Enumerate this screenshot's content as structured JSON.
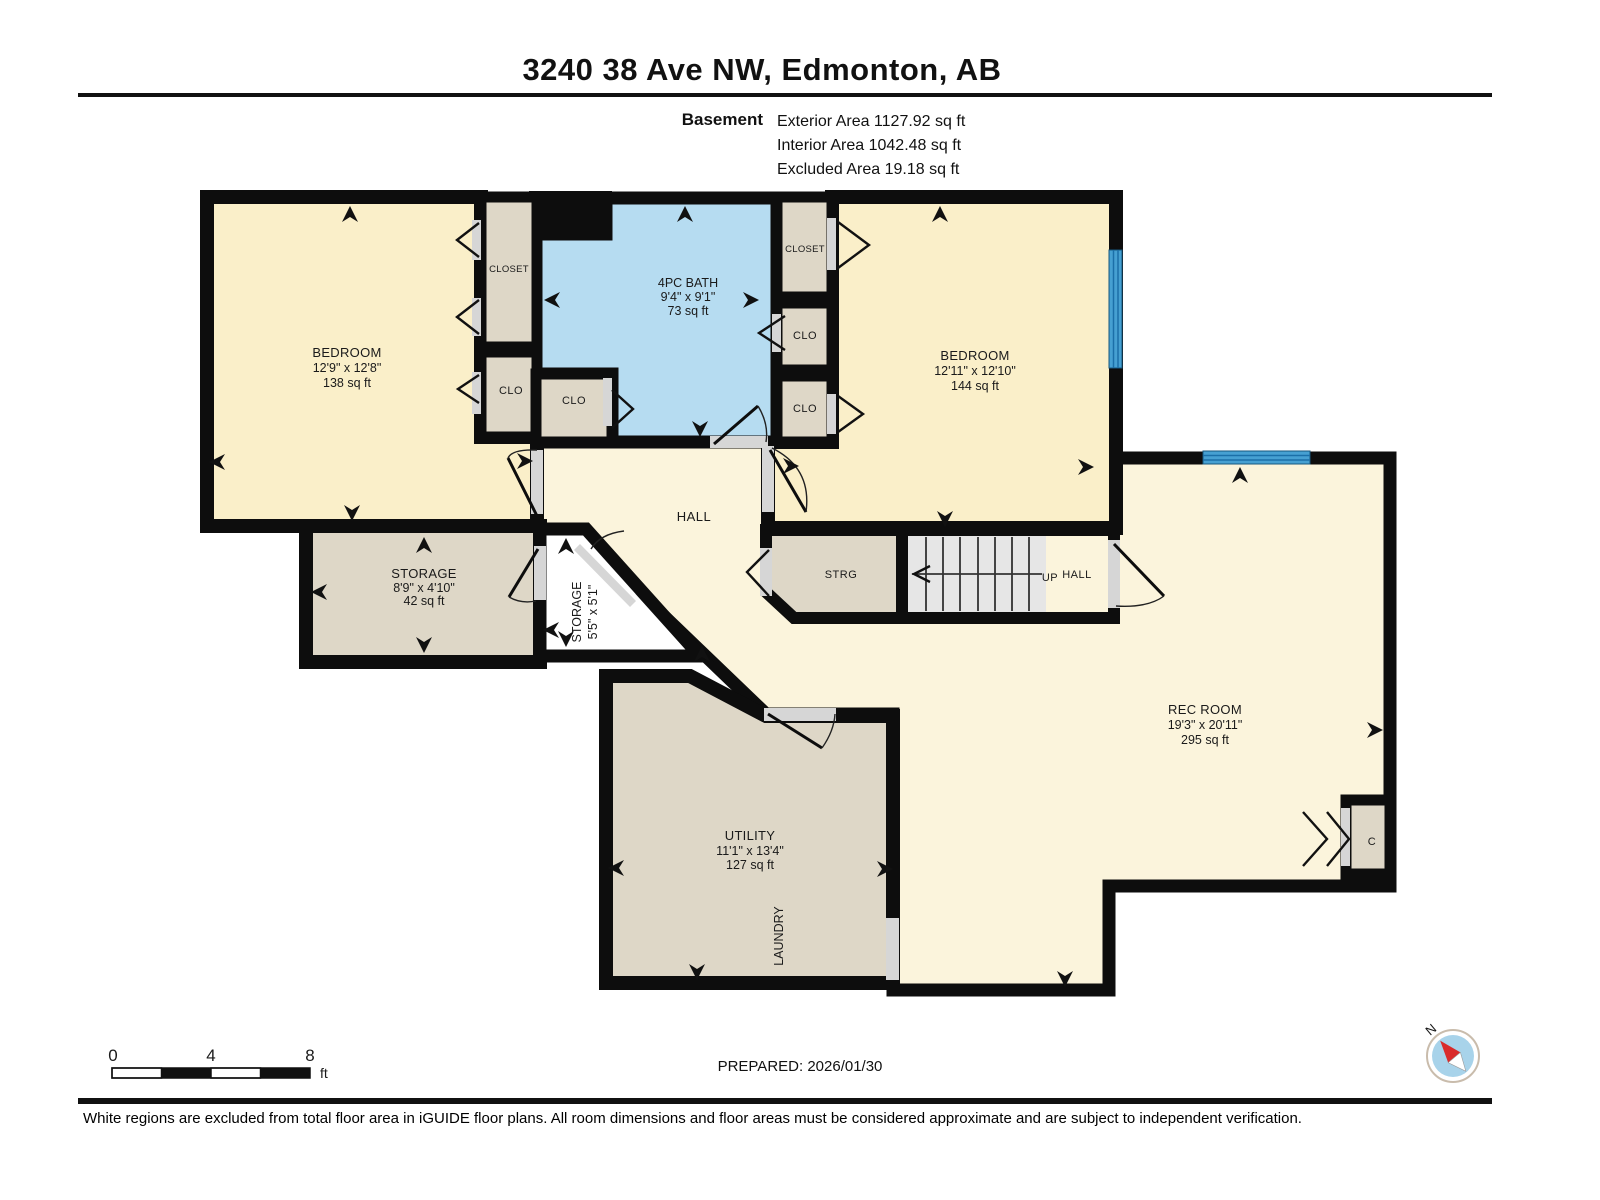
{
  "header": {
    "title": "3240 38 Ave NW, Edmonton, AB",
    "floor_label": "Basement",
    "area_lines": [
      {
        "label": "Exterior Area",
        "value": "1127.92 sq ft",
        "text": "Exterior Area 1127.92 sq ft"
      },
      {
        "label": "Interior Area",
        "value": "1042.48 sq ft",
        "text": "Interior Area 1042.48 sq ft"
      },
      {
        "label": "Excluded Area",
        "value": "19.18 sq ft",
        "text": "Excluded Area 19.18 sq ft"
      }
    ]
  },
  "rooms": {
    "bedroom_left": {
      "name": "BEDROOM",
      "dims": "12'9\" x 12'8\"",
      "area": "138 sq ft"
    },
    "bedroom_right": {
      "name": "BEDROOM",
      "dims": "12'11\" x 12'10\"",
      "area": "144 sq ft"
    },
    "bath": {
      "name": "4PC BATH",
      "dims": "9'4\" x 9'1\"",
      "area": "73 sq ft"
    },
    "rec_room": {
      "name": "REC ROOM",
      "dims": "19'3\" x 20'11\"",
      "area": "295 sq ft"
    },
    "utility": {
      "name": "UTILITY",
      "dims": "11'1\" x 13'4\"",
      "area": "127 sq ft"
    },
    "laundry": {
      "name": "LAUNDRY"
    },
    "storage": {
      "name": "STORAGE",
      "dims": "8'9\" x 4'10\"",
      "area": "42 sq ft"
    },
    "storage_small": {
      "name": "STORAGE",
      "dims": "5'5\" x 5'1\""
    },
    "hall": {
      "name": "HALL"
    },
    "strg": {
      "name": "STRG"
    },
    "stairs": {
      "up_label": "UP"
    },
    "hall_landing": {
      "name": "HALL"
    },
    "closet_left": {
      "name": "CLOSET"
    },
    "clo_left": {
      "name": "CLO"
    },
    "clo_bath": {
      "name": "CLO"
    },
    "closet_right": {
      "name": "CLOSET"
    },
    "clo_right_mid": {
      "name": "CLO"
    },
    "clo_right_bot": {
      "name": "CLO"
    },
    "closet_rec": {
      "name": "C"
    }
  },
  "footer": {
    "scale": {
      "t0": "0",
      "t4": "4",
      "t8": "8",
      "unit": "ft"
    },
    "prepared": "PREPARED: 2026/01/30",
    "compass_label": "N",
    "disclaimer": "White regions are excluded from total floor area in iGUIDE floor plans. All room dimensions and floor areas must be considered approximate and are subject to independent verification."
  },
  "colors": {
    "room_warm": "#FAEFC9",
    "room_light": "#FBF4DC",
    "closet_tan": "#DED7C7",
    "bath_blue": "#B6DCF1",
    "window_blue": "#46A0D2",
    "window_dark": "#1B6FA8",
    "wall": "#0D0D0D",
    "door_gray": "#D6D6D6",
    "stairs_gray": "#E6E6E6",
    "compass_red": "#D92B2B",
    "compass_blue": "#A8D3EA"
  }
}
